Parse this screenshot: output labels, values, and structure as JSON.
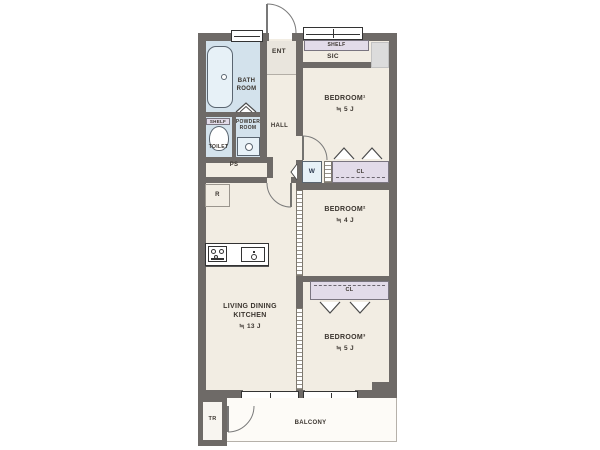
{
  "colors": {
    "wall": "#6e6a67",
    "floor": "#f2ede3",
    "wet_room": "#d3e2ec",
    "fixture": "#e7f1f7",
    "closet": "#e2dbe9",
    "entrance_floor": "#e9e5dd",
    "text": "#3b352f"
  },
  "rooms": {
    "entrance": {
      "label": "ENT"
    },
    "shoe_closet": {
      "label": "SIC",
      "shelf_label": "SHELF"
    },
    "hall": {
      "label": "HALL"
    },
    "bathroom": {
      "label_line1": "BATH",
      "label_line2": "ROOM"
    },
    "toilet": {
      "label": "TOILET",
      "shelf_label": "SHELF"
    },
    "powder_room": {
      "label_line1": "POWDER",
      "label_line2": "ROOM"
    },
    "pipe_space": {
      "label": "PS"
    },
    "refrigerator_space": {
      "label": "R"
    },
    "washing_machine": {
      "label": "W"
    },
    "closet_1": {
      "label": "CL"
    },
    "closet_2": {
      "label": "CL"
    },
    "bedroom_1": {
      "name": "BEDROOM¹",
      "area": "≒ 5 J"
    },
    "bedroom_2": {
      "name": "BEDROOM²",
      "area": "≒ 4 J"
    },
    "bedroom_3": {
      "name": "BEDROOM³",
      "area": "≒ 5 J"
    },
    "ldk": {
      "name_line1": "LIVING DINING",
      "name_line2": "KITCHEN",
      "area": "≒ 13 J"
    },
    "balcony": {
      "label": "BALCONY"
    },
    "trunk_room": {
      "label": "TR"
    }
  }
}
